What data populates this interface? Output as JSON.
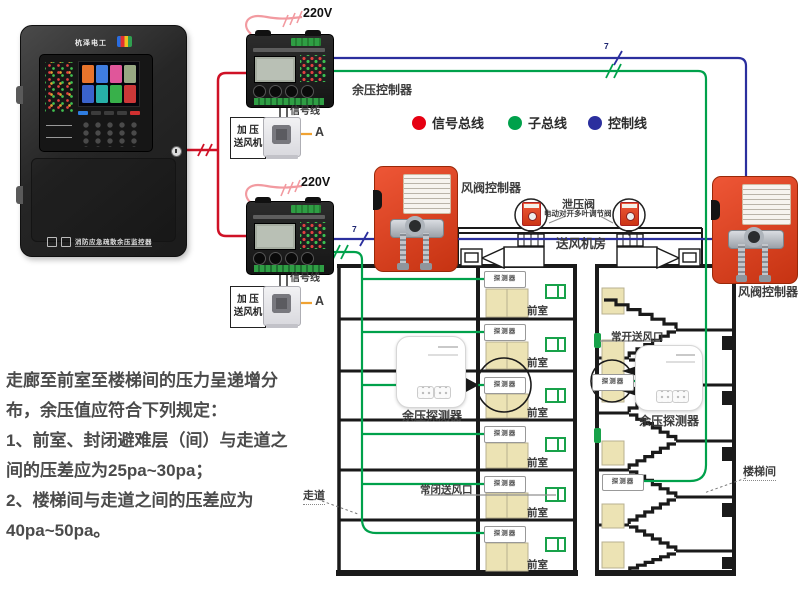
{
  "cabinet": {
    "brand": "杭泽电工",
    "model_strip": "消防应急疏散余压监控器"
  },
  "power": {
    "label": "220V"
  },
  "wires": {
    "legend": [
      {
        "label": "信号总线",
        "color": "#e60012"
      },
      {
        "label": "子总线",
        "color": "#00a14b"
      },
      {
        "label": "控制线",
        "color": "#2b2f9e"
      }
    ],
    "count_mark": "7"
  },
  "devices": {
    "controller_label": "余压控制器",
    "signal_line": "信号线",
    "fan_box_line1": "加 压",
    "fan_box_line2": "送风机",
    "ammeter": "A",
    "damper_controller": "风阀控制器",
    "relief_valve": "泄压阀",
    "relief_valve_sub": "电动对开多叶调节阀",
    "fan_room": "送风机房",
    "pressure_detector": "余压探测器",
    "detector": "探测器"
  },
  "building": {
    "front_room": "前室",
    "corridor": "走道",
    "stairwell": "楼梯间",
    "nc_outlet": "常闭送风口",
    "no_outlet": "常开送风口"
  },
  "note": {
    "lines": [
      "走廊至前室至楼梯间的压力呈递增分",
      "布，余压值应符合下列规定：",
      "1、前室、封闭避难层（间）与走道之",
      "间的压差应为25pa~30pa；",
      "2、楼梯间与走道之间的压差应为",
      "40pa~50pa。"
    ]
  }
}
